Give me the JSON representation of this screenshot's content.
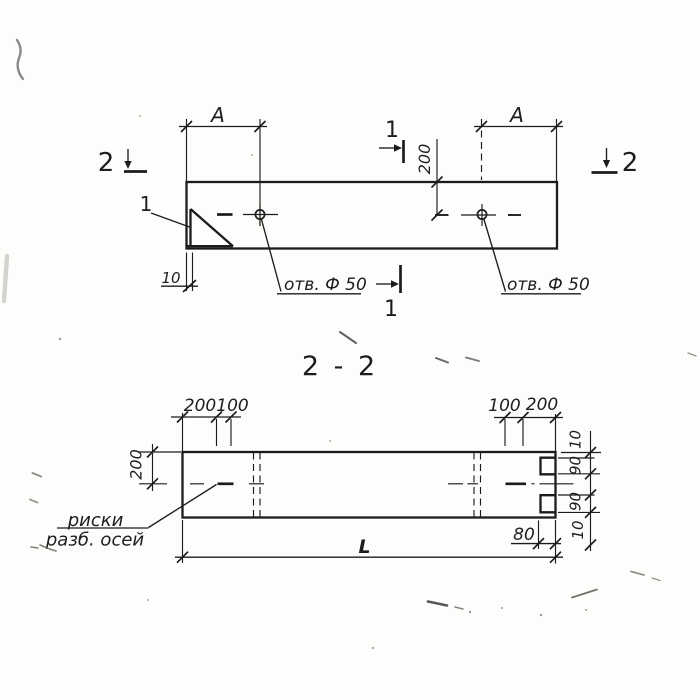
{
  "title": "2 - 2",
  "colors": {
    "ink": "#1c1c1a",
    "paper": "#fdfdfc"
  },
  "top_view": {
    "mark_2_left": "2",
    "mark_2_right": "2",
    "mark_1_top": "1",
    "mark_1_bottom": "1",
    "detail_ref": "1",
    "dim_a_left": "A",
    "dim_a_right": "A",
    "dim_depth": "200",
    "dim_plate": "10",
    "hole_left": "отв. Ф 50",
    "hole_right": "отв. Ф 50"
  },
  "section_view": {
    "dim_left_200": "200",
    "dim_left_100": "100",
    "dim_right_100": "100",
    "dim_right_200": "200",
    "dim_height": "200",
    "dims_right": [
      "10",
      "90",
      "90",
      "10"
    ],
    "dim_notch_depth": "80",
    "dim_length": "L",
    "axis_line1": "риски",
    "axis_line2": "разб. осей"
  }
}
